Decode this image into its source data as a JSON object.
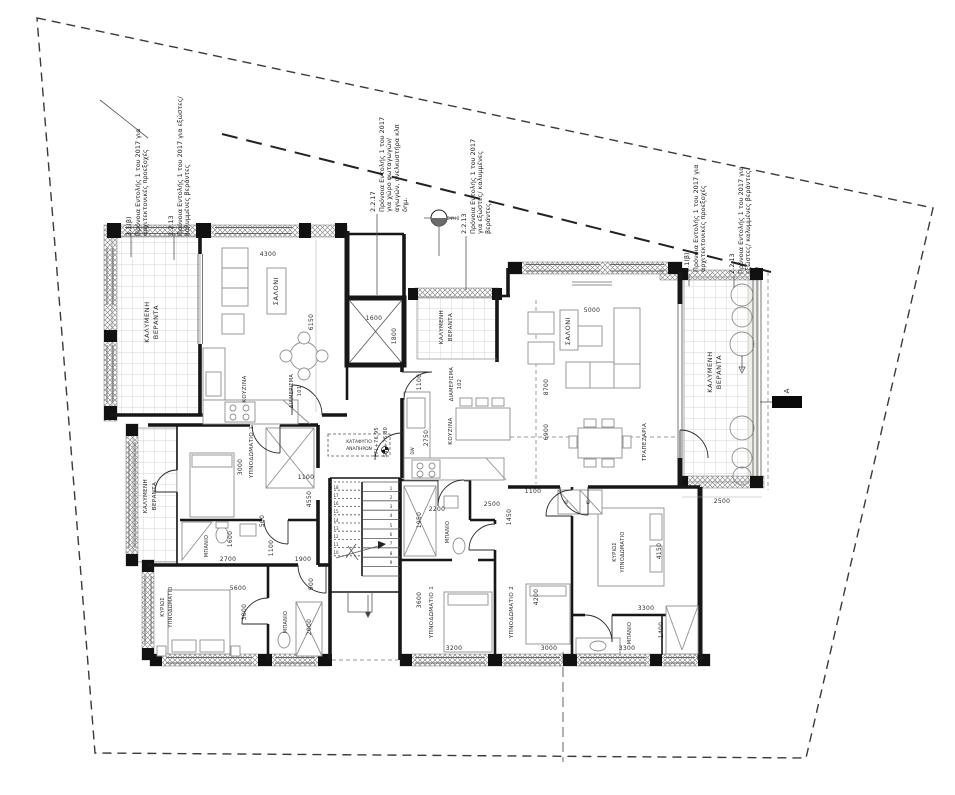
{
  "drawing": {
    "annotations": {
      "a31b_code": "3.1(β)",
      "a31b_text": "Πρόνοια Εντολής 1 του 2017 για αρχιτεκτονικές προεξοχές",
      "a2213_code": "2.2.13",
      "a2213_text": "Πρόνοια Εντολής 1 του 2017 για εξώστες/ καλυμμένες βεράντες",
      "a2217_code": "2.2.17",
      "a2217_text": "Πρόνοια Εντολής 1 του 2017 για χώρο φωταγωγών/αγωγών, ανελκυστήρα κλπ δημ."
    },
    "markers": {
      "elevation": "ΟΨΗ 2",
      "section": "A",
      "ffl": "FFL+76,95",
      "ssl": "SSL+76,80",
      "shelter_line1": "ΚΑΤΑΦΥΓΙΟ",
      "shelter_line2": "ΑΝΑΠΗΡΩΝ",
      "dw": "DW",
      "w": "W"
    },
    "rooms": {
      "veranda_line1": "ΚΑΛΥΜΕΝΗ",
      "veranda_line2": "ΒΕΡΑΝΤΑ",
      "salon": "ΣΑΛΟΝΙ",
      "kitchen": "ΚΟΥΖΙΝΑ",
      "dining": "ΤΡΑΠΕΖΑΡΙΑ",
      "bedroom1": "ΥΠΝΟΔΩΜΑΤΙΟ 1",
      "bedroom2": "ΥΠΝΟΔΩΜΑΤΙΟ 2",
      "master_line1": "ΚΥΡΙΩΣ",
      "master_line2": "ΥΠΝΟΔΩΜΑΤΙΟ",
      "bath": "ΜΠΑΝΙΟ",
      "apt_label": "ΔΙΑΜΕΡΙΣΜΑ",
      "apt101": "101",
      "apt102": "102"
    },
    "dims": {
      "4300": "4300",
      "6150": "6150",
      "1600": "1600",
      "1800": "1800",
      "2750": "2750",
      "5000": "5000",
      "8700": "8700",
      "6900": "6900",
      "2500": "2500",
      "3000": "3000",
      "4550": "4550",
      "1100": "1100",
      "500": "500",
      "2700": "2700",
      "1900": "1900",
      "900": "900",
      "5600": "5600",
      "2000": "2000",
      "2200": "2200",
      "1450": "1450",
      "1950": "1950",
      "3600": "3600",
      "3200": "3200",
      "4200": "4200",
      "4150": "4150",
      "3300": "3300",
      "1400": "1400"
    },
    "stairs": {
      "steps": [
        "1",
        "2",
        "3",
        "4",
        "5",
        "6",
        "7",
        "8",
        "9",
        "10",
        "11",
        "12",
        "13",
        "14",
        "15",
        "16",
        "17",
        "18"
      ]
    }
  }
}
